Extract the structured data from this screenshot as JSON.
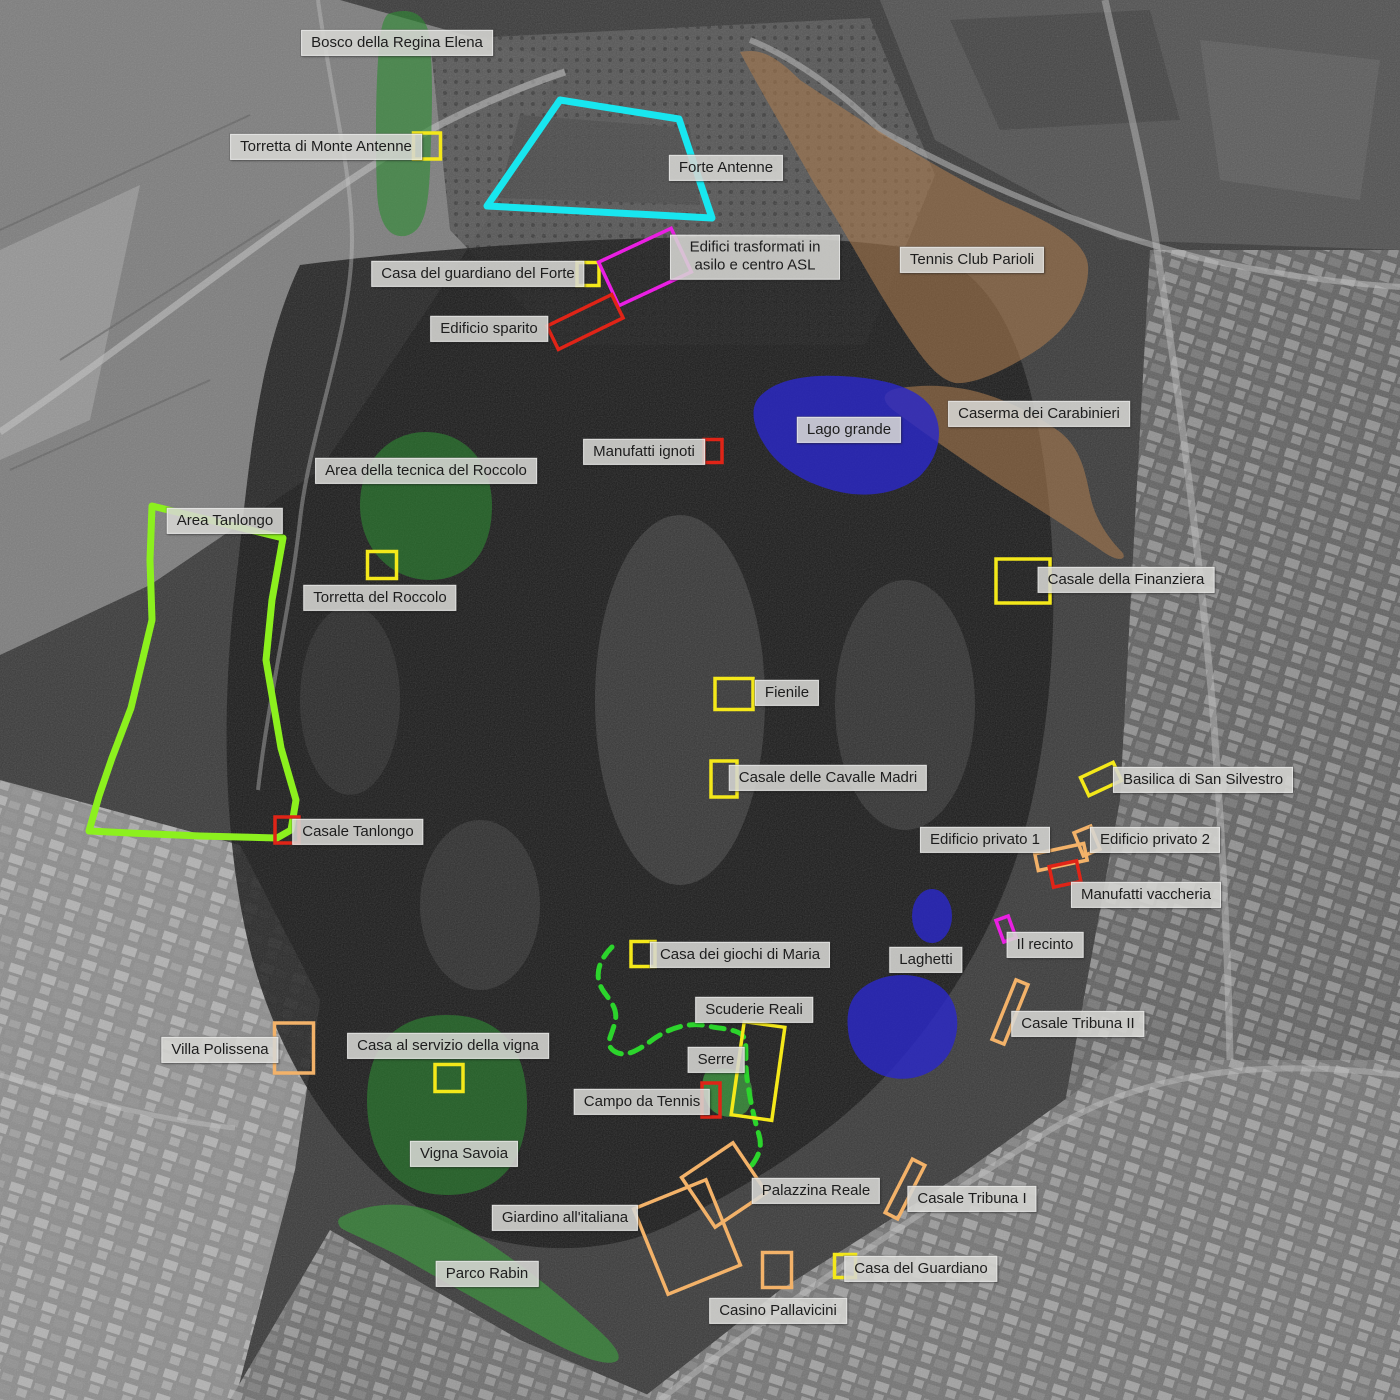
{
  "map_description": "Annotated historical aerial photograph of Villa Ada park (Rome) with colored site overlays and Italian place labels",
  "palette": {
    "yellow": "#f4e81a",
    "red": "#e02417",
    "magenta": "#ea1fe3",
    "orange": "#f3b269",
    "cyan": "#18e6ef",
    "lime": "#8cf01e",
    "dash_green": "#2cd42c",
    "overlay_green": "#2f8b33",
    "overlay_blue": "#2b28c8",
    "overlay_brown": "#a87a4e",
    "label_bg": "#d6d6d3",
    "label_text": "#1d1d1d"
  },
  "labels": [
    {
      "id": "bosco-regina-elena",
      "text": "Bosco della Regina Elena",
      "x": 397,
      "y": 43
    },
    {
      "id": "torretta-monte-antenne",
      "text": "Torretta di Monte Antenne",
      "x": 326,
      "y": 147
    },
    {
      "id": "forte-antenne",
      "text": "Forte Antenne",
      "x": 726,
      "y": 168
    },
    {
      "id": "casa-guardiano-forte",
      "text": "Casa del guardiano del Forte",
      "x": 478,
      "y": 274
    },
    {
      "id": "edifici-asilo-asl",
      "text": "Edifici trasformati in asilo e centro ASL",
      "x": 755,
      "y": 257,
      "maxw": 150
    },
    {
      "id": "edificio-sparito",
      "text": "Edificio sparito",
      "x": 489,
      "y": 329
    },
    {
      "id": "tennis-club-parioli",
      "text": "Tennis Club Parioli",
      "x": 972,
      "y": 260
    },
    {
      "id": "caserma-carabinieri",
      "text": "Caserma dei Carabinieri",
      "x": 1039,
      "y": 414
    },
    {
      "id": "lago-grande",
      "text": "Lago grande",
      "x": 849,
      "y": 430
    },
    {
      "id": "manufatti-ignoti",
      "text": "Manufatti ignoti",
      "x": 644,
      "y": 452
    },
    {
      "id": "area-tecnica-roccolo",
      "text": "Area della tecnica del Roccolo",
      "x": 426,
      "y": 471
    },
    {
      "id": "area-tanlongo",
      "text": "Area Tanlongo",
      "x": 225,
      "y": 521
    },
    {
      "id": "torretta-roccolo",
      "text": "Torretta del Roccolo",
      "x": 380,
      "y": 598
    },
    {
      "id": "casale-finanziera",
      "text": "Casale della Finanziera",
      "x": 1126,
      "y": 580
    },
    {
      "id": "fienile",
      "text": "Fienile",
      "x": 787,
      "y": 693
    },
    {
      "id": "casale-cavalle-madri",
      "text": "Casale delle Cavalle Madri",
      "x": 828,
      "y": 778
    },
    {
      "id": "basilica-san-silvestro",
      "text": "Basilica di San Silvestro",
      "x": 1203,
      "y": 780
    },
    {
      "id": "edificio-privato-1",
      "text": "Edificio privato 1",
      "x": 985,
      "y": 840
    },
    {
      "id": "edificio-privato-2",
      "text": "Edificio privato 2",
      "x": 1155,
      "y": 840
    },
    {
      "id": "manufatti-vaccheria",
      "text": "Manufatti vaccheria",
      "x": 1146,
      "y": 895
    },
    {
      "id": "casale-tanlongo",
      "text": "Casale Tanlongo",
      "x": 358,
      "y": 832
    },
    {
      "id": "il-recinto",
      "text": "Il recinto",
      "x": 1045,
      "y": 945
    },
    {
      "id": "laghetti",
      "text": "Laghetti",
      "x": 926,
      "y": 960
    },
    {
      "id": "casa-giochi-maria",
      "text": "Casa dei giochi di Maria",
      "x": 740,
      "y": 955
    },
    {
      "id": "casale-tribuna-2",
      "text": "Casale Tribuna II",
      "x": 1078,
      "y": 1024
    },
    {
      "id": "scuderie-reali",
      "text": "Scuderie Reali",
      "x": 754,
      "y": 1010
    },
    {
      "id": "villa-polissena",
      "text": "Villa Polissena",
      "x": 220,
      "y": 1050
    },
    {
      "id": "casa-servizio-vigna",
      "text": "Casa al servizio della vigna",
      "x": 448,
      "y": 1046
    },
    {
      "id": "serre",
      "text": "Serre",
      "x": 716,
      "y": 1060
    },
    {
      "id": "campo-da-tennis",
      "text": "Campo da Tennis",
      "x": 642,
      "y": 1102
    },
    {
      "id": "vigna-savoia",
      "text": "Vigna Savoia",
      "x": 464,
      "y": 1154
    },
    {
      "id": "palazzina-reale",
      "text": "Palazzina Reale",
      "x": 816,
      "y": 1191
    },
    {
      "id": "casale-tribuna-1",
      "text": "Casale Tribuna I",
      "x": 972,
      "y": 1199
    },
    {
      "id": "giardino-italiana",
      "text": "Giardino all'italiana",
      "x": 565,
      "y": 1218
    },
    {
      "id": "parco-rabin",
      "text": "Parco Rabin",
      "x": 487,
      "y": 1274
    },
    {
      "id": "casa-del-guardiano",
      "text": "Casa del Guardiano",
      "x": 921,
      "y": 1269
    },
    {
      "id": "casino-pallavicini",
      "text": "Casino Pallavicini",
      "x": 778,
      "y": 1311
    }
  ],
  "markers": [
    {
      "id": "torretta-monte-antenne",
      "color": "yellow",
      "cx": 427,
      "cy": 146,
      "w": 27,
      "h": 26,
      "rot": 0
    },
    {
      "id": "casa-guardiano-forte",
      "color": "yellow",
      "cx": 588,
      "cy": 274,
      "w": 22,
      "h": 23,
      "rot": 0
    },
    {
      "id": "edifici-asilo-asl",
      "color": "magenta",
      "cx": 645,
      "cy": 267,
      "w": 80,
      "h": 48,
      "rot": -25
    },
    {
      "id": "edificio-sparito",
      "color": "red",
      "cx": 585,
      "cy": 322,
      "w": 72,
      "h": 26,
      "rot": -26
    },
    {
      "id": "manufatti-ignoti",
      "color": "red",
      "cx": 713,
      "cy": 451,
      "w": 18,
      "h": 23,
      "rot": 0
    },
    {
      "id": "torretta-roccolo",
      "color": "yellow",
      "cx": 382,
      "cy": 565,
      "w": 29,
      "h": 27,
      "rot": 0
    },
    {
      "id": "casale-finanziera",
      "color": "yellow",
      "cx": 1023,
      "cy": 581,
      "w": 54,
      "h": 44,
      "rot": 0
    },
    {
      "id": "fienile",
      "color": "yellow",
      "cx": 734,
      "cy": 694,
      "w": 38,
      "h": 31,
      "rot": 0
    },
    {
      "id": "casale-cavalle-madri",
      "color": "yellow",
      "cx": 724,
      "cy": 779,
      "w": 26,
      "h": 36,
      "rot": 0
    },
    {
      "id": "basilica-san-silvestro",
      "color": "yellow",
      "cx": 1101,
      "cy": 779,
      "w": 36,
      "h": 20,
      "rot": -25
    },
    {
      "id": "edificio-privato-1",
      "color": "orange",
      "cx": 1061,
      "cy": 857,
      "w": 50,
      "h": 17,
      "rot": -12
    },
    {
      "id": "edificio-privato-2",
      "color": "orange",
      "cx": 1087,
      "cy": 841,
      "w": 18,
      "h": 25,
      "rot": -22
    },
    {
      "id": "manufatti-vaccheria",
      "color": "red",
      "cx": 1065,
      "cy": 874,
      "w": 28,
      "h": 21,
      "rot": -12
    },
    {
      "id": "casale-tanlongo",
      "color": "red",
      "cx": 287,
      "cy": 830,
      "w": 24,
      "h": 26,
      "rot": 0
    },
    {
      "id": "il-recinto",
      "color": "magenta",
      "cx": 1006,
      "cy": 929,
      "w": 13,
      "h": 23,
      "rot": -20
    },
    {
      "id": "casa-giochi-maria",
      "color": "yellow",
      "cx": 643,
      "cy": 954,
      "w": 24,
      "h": 25,
      "rot": 0
    },
    {
      "id": "casale-tribuna-2",
      "color": "orange",
      "cx": 1010,
      "cy": 1012,
      "w": 13,
      "h": 64,
      "rot": 22
    },
    {
      "id": "scuderie-reali",
      "color": "yellow",
      "cx": 758,
      "cy": 1071,
      "w": 41,
      "h": 94,
      "rot": 8
    },
    {
      "id": "villa-polissena",
      "color": "orange",
      "cx": 294,
      "cy": 1048,
      "w": 39,
      "h": 50,
      "rot": 0
    },
    {
      "id": "casa-servizio-vigna",
      "color": "yellow",
      "cx": 449,
      "cy": 1078,
      "w": 28,
      "h": 27,
      "rot": 0
    },
    {
      "id": "campo-da-tennis",
      "color": "red",
      "cx": 711,
      "cy": 1100,
      "w": 18,
      "h": 34,
      "rot": 0
    },
    {
      "id": "palazzina-reale",
      "color": "orange",
      "cx": 724,
      "cy": 1185,
      "w": 62,
      "h": 60,
      "rot": -34
    },
    {
      "id": "casale-tribuna-1",
      "color": "orange",
      "cx": 905,
      "cy": 1189,
      "w": 14,
      "h": 60,
      "rot": 27
    },
    {
      "id": "giardino-italiana",
      "color": "orange",
      "cx": 687,
      "cy": 1237,
      "w": 78,
      "h": 92,
      "rot": -22
    },
    {
      "id": "casino-pallavicini",
      "color": "orange",
      "cx": 777,
      "cy": 1270,
      "w": 29,
      "h": 35,
      "rot": 0
    },
    {
      "id": "casa-del-guardiano",
      "color": "yellow",
      "cx": 845,
      "cy": 1266,
      "w": 21,
      "h": 23,
      "rot": 0
    }
  ]
}
